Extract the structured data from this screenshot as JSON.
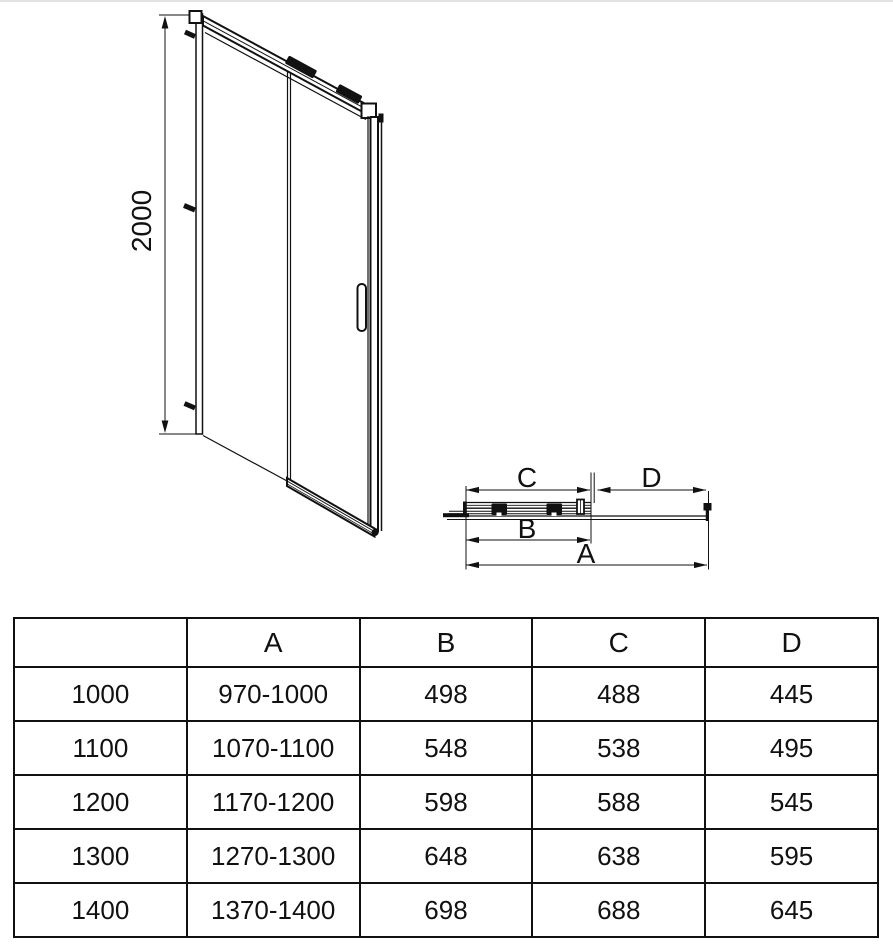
{
  "front_view": {
    "description": "sliding shower door front elevation",
    "height_label": "2000"
  },
  "plan_view": {
    "description": "sliding shower door top/plan section with dimension letters",
    "dim_c_label": "C",
    "dim_d_label": "D",
    "dim_b_label": "B",
    "dim_a_label": "A"
  },
  "size_table": {
    "headers": [
      "",
      "A",
      "B",
      "C",
      "D"
    ],
    "rows": [
      [
        "1000",
        "970-1000",
        "498",
        "488",
        "445"
      ],
      [
        "1100",
        "1070-1100",
        "548",
        "538",
        "495"
      ],
      [
        "1200",
        "1170-1200",
        "598",
        "588",
        "545"
      ],
      [
        "1300",
        "1270-1300",
        "648",
        "638",
        "595"
      ],
      [
        "1400",
        "1370-1400",
        "698",
        "688",
        "645"
      ]
    ]
  },
  "colors": {
    "line": "#111111",
    "background": "#ffffff",
    "page_edge": "#e2e2e2"
  }
}
